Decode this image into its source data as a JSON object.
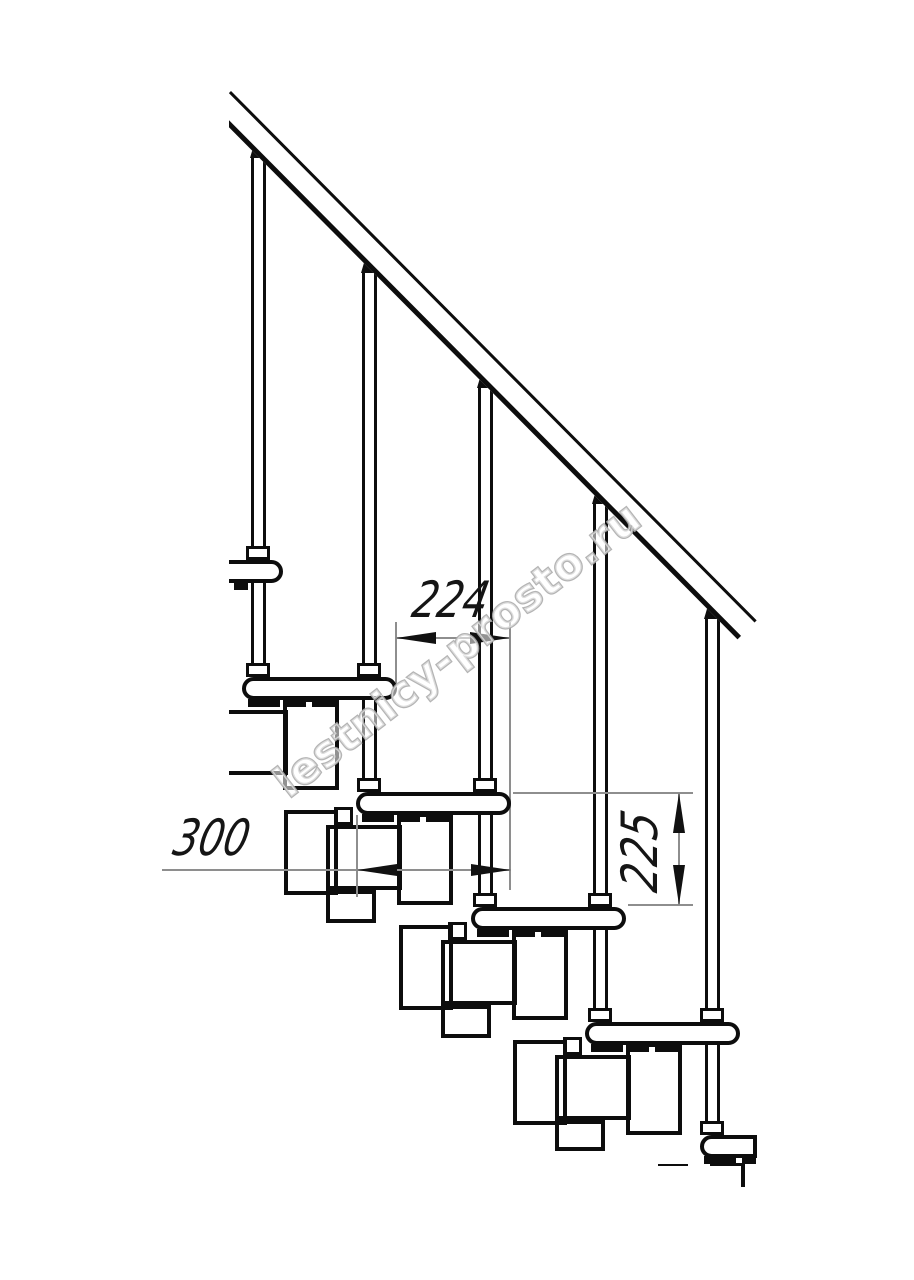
{
  "drawing": {
    "kind": "modular staircase side elevation, technical line drawing",
    "units_shown": "mm"
  },
  "dimensions": {
    "step_run": {
      "value": "224",
      "orientation": "horizontal"
    },
    "tread_depth": {
      "value": "300",
      "orientation": "horizontal"
    },
    "step_rise": {
      "value": "225",
      "orientation": "vertical"
    }
  },
  "watermark": {
    "text": "lestnicy-prosto.ru"
  },
  "colors": {
    "background": "#ffffff",
    "line": "#0d0d0d",
    "dimension_line": "#8e8e8e",
    "dimension_text": "#151515",
    "watermark_stroke": "#acacac"
  }
}
